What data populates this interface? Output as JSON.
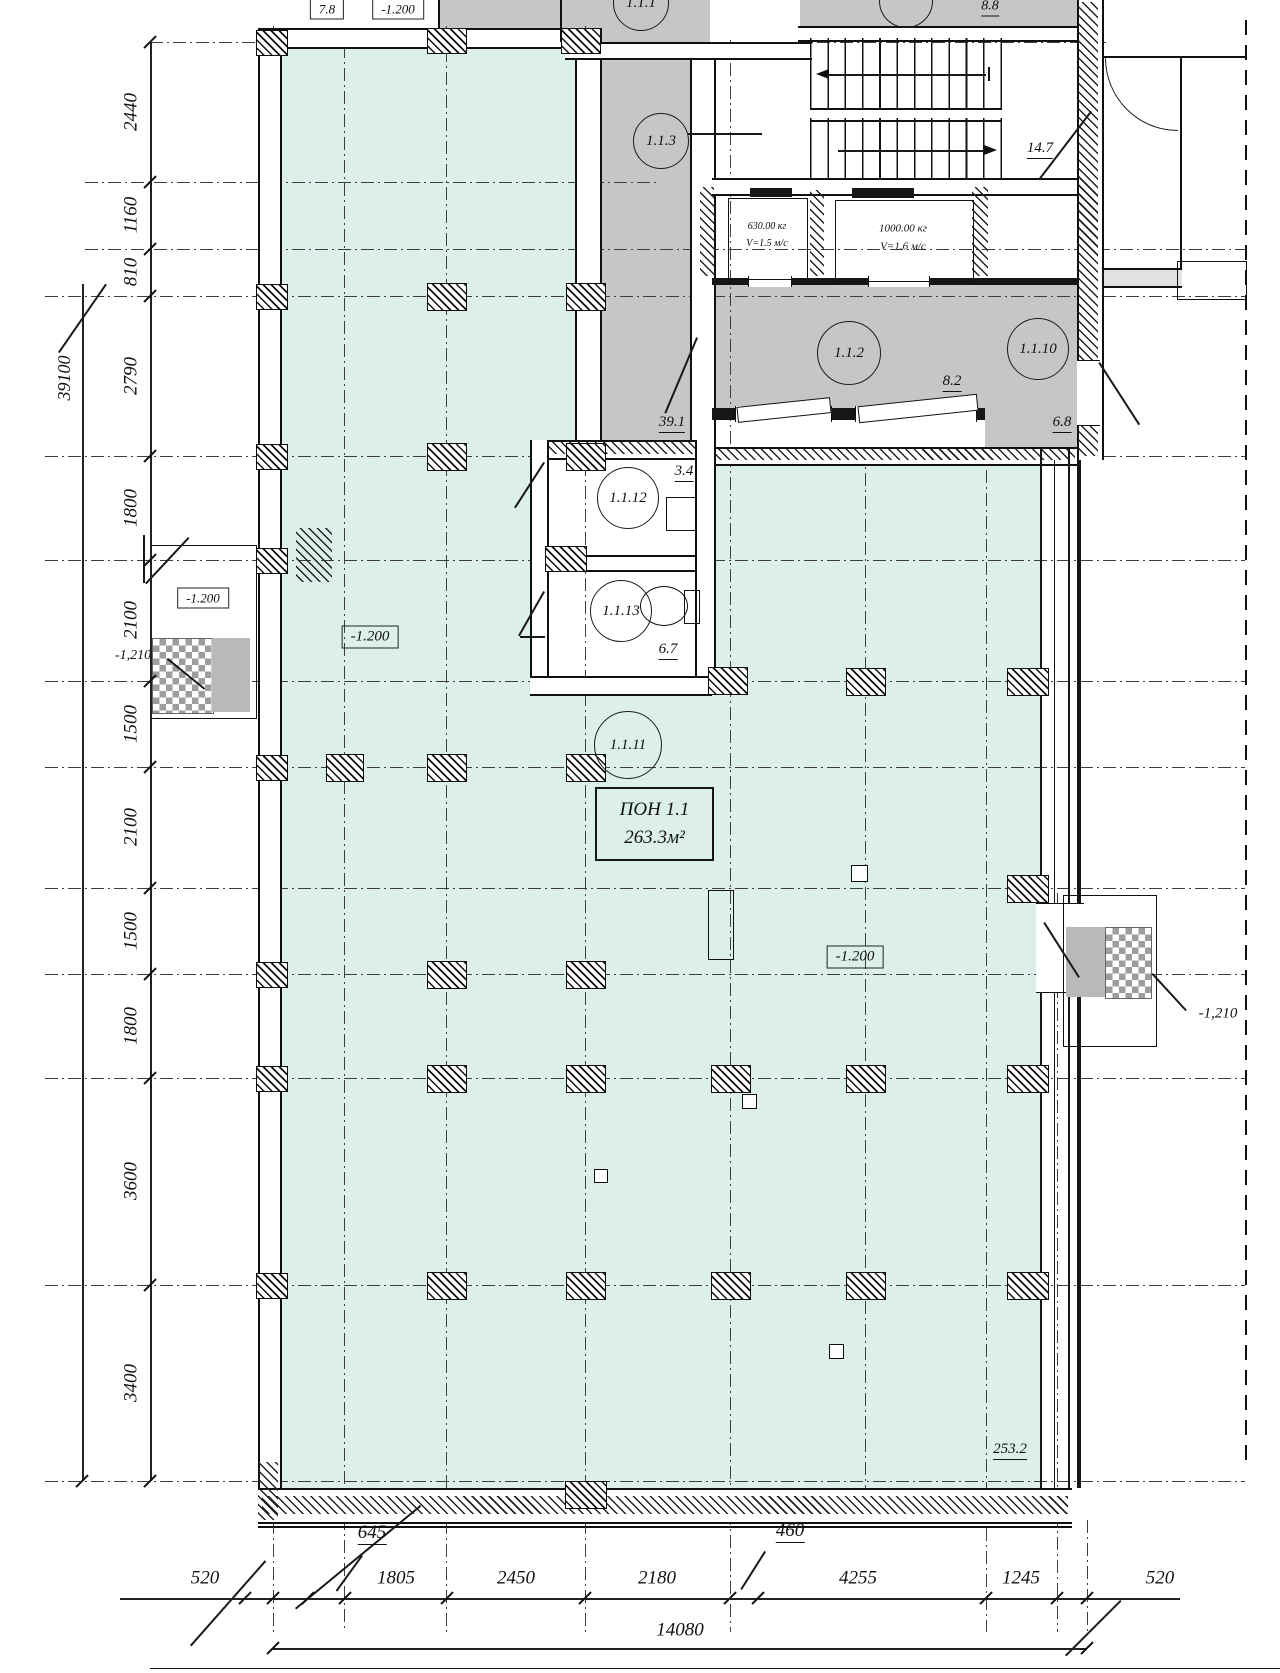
{
  "canvas": {
    "w": 1280,
    "h": 1673
  },
  "colors": {
    "hall_fill": "#dcefe8",
    "room_fill": "#c6c6c6",
    "line": "#161616"
  },
  "zone": {
    "box": [
      595,
      787,
      115,
      70
    ],
    "line1": "ПОН 1.1",
    "line2": "263.3м²"
  },
  "room_tags": [
    {
      "label": "1.1.1",
      "cx": 640,
      "cy": 2,
      "r": 27
    },
    {
      "label": "",
      "cx": 905,
      "cy": 0,
      "r": 26
    },
    {
      "label": "1.1.3",
      "cx": 660,
      "cy": 140,
      "r": 27
    },
    {
      "label": "1.1.2",
      "cx": 848,
      "cy": 352,
      "r": 31
    },
    {
      "label": "1.1.10",
      "cx": 1037,
      "cy": 348,
      "r": 30
    },
    {
      "label": "1.1.12",
      "cx": 627,
      "cy": 497,
      "r": 30
    },
    {
      "label": "1.1.13",
      "cx": 620,
      "cy": 610,
      "r": 30
    },
    {
      "label": "1.1.11",
      "cx": 627,
      "cy": 744,
      "r": 33
    }
  ],
  "labels": [
    {
      "t": "7.8",
      "x": 327,
      "y": 9,
      "s": 13,
      "st": "bx"
    },
    {
      "t": "-1.200",
      "x": 398,
      "y": 9,
      "s": 13,
      "st": "bx"
    },
    {
      "t": "8.8",
      "x": 990,
      "y": 8,
      "s": 14,
      "st": "u"
    },
    {
      "t": "14.7",
      "x": 1040,
      "y": 150,
      "s": 15,
      "st": "u"
    },
    {
      "t": "630.00 кг",
      "x": 767,
      "y": 227,
      "s": 10
    },
    {
      "t": "V=1.5 м/с",
      "x": 767,
      "y": 244,
      "s": 10
    },
    {
      "t": "1000.00 кг",
      "x": 903,
      "y": 229,
      "s": 11
    },
    {
      "t": "V=1.6 м/с",
      "x": 903,
      "y": 247,
      "s": 11
    },
    {
      "t": "8.2",
      "x": 952,
      "y": 383,
      "s": 15,
      "st": "u"
    },
    {
      "t": "6.8",
      "x": 1062,
      "y": 424,
      "s": 15,
      "st": "u"
    },
    {
      "t": "39.1",
      "x": 672,
      "y": 424,
      "s": 15,
      "st": "u"
    },
    {
      "t": "3.4",
      "x": 684,
      "y": 473,
      "s": 15,
      "st": "u"
    },
    {
      "t": "6.7",
      "x": 668,
      "y": 651,
      "s": 15,
      "st": "u"
    },
    {
      "t": "253.2",
      "x": 1010,
      "y": 1451,
      "s": 15,
      "st": "u"
    },
    {
      "t": "-1.200",
      "x": 370,
      "y": 637,
      "s": 15,
      "st": "bx"
    },
    {
      "t": "-1.200",
      "x": 855,
      "y": 957,
      "s": 15,
      "st": "bx"
    },
    {
      "t": "-1.200",
      "x": 203,
      "y": 598,
      "s": 13,
      "st": "bx"
    },
    {
      "t": "-1,210",
      "x": 133,
      "y": 656,
      "s": 14
    },
    {
      "t": "-1,210",
      "x": 1218,
      "y": 1014,
      "s": 15
    },
    {
      "t": "39100",
      "x": 64,
      "y": 378,
      "s": 18,
      "r": -90
    }
  ],
  "dims_left": {
    "line": {
      "x": 150,
      "y1": 42,
      "y2": 1481
    },
    "outer_line": {
      "x": 82,
      "y1": 284,
      "y2": 1481
    },
    "ticks": [
      42,
      182,
      249,
      296,
      456,
      560,
      681,
      767,
      888,
      974,
      1078,
      1285,
      1481
    ],
    "labels": [
      {
        "t": "2440",
        "y": 112
      },
      {
        "t": "1160",
        "y": 215
      },
      {
        "t": "810",
        "y": 272
      },
      {
        "t": "2790",
        "y": 376
      },
      {
        "t": "1800",
        "y": 508
      },
      {
        "t": "2100",
        "y": 620
      },
      {
        "t": "1500",
        "y": 724
      },
      {
        "t": "2100",
        "y": 827
      },
      {
        "t": "1500",
        "y": 931
      },
      {
        "t": "1800",
        "y": 1026
      },
      {
        "t": "3600",
        "y": 1181
      },
      {
        "t": "3400",
        "y": 1383
      }
    ],
    "label_x": 131,
    "total": "39100"
  },
  "dims_bottom": {
    "line": {
      "y": 1598,
      "x1": 120,
      "x2": 1180
    },
    "ticks": [
      245,
      273,
      308,
      345,
      447,
      585,
      730,
      758,
      986,
      1057,
      1087
    ],
    "labels": [
      {
        "t": "520",
        "x": 205,
        "y": 1578
      },
      {
        "t": "645",
        "x": 372,
        "y": 1534,
        "st": "u"
      },
      {
        "t": "1805",
        "x": 396,
        "y": 1578
      },
      {
        "t": "2450",
        "x": 516,
        "y": 1578
      },
      {
        "t": "2180",
        "x": 657,
        "y": 1578
      },
      {
        "t": "460",
        "x": 790,
        "y": 1532,
        "st": "u"
      },
      {
        "t": "4255",
        "x": 858,
        "y": 1578
      },
      {
        "t": "1245",
        "x": 1021,
        "y": 1578
      },
      {
        "t": "520",
        "x": 1160,
        "y": 1578
      }
    ],
    "total": {
      "t": "14080",
      "x": 680,
      "y": 1630,
      "line_y": 1648,
      "x1": 273,
      "x2": 1087
    },
    "base_line": {
      "y": 1668,
      "x1": 150,
      "x2": 1280
    }
  },
  "grid": {
    "h": [
      {
        "y": 42,
        "x1": 150,
        "x2": 1110
      },
      {
        "y": 182,
        "x1": 85,
        "x2": 660
      },
      {
        "y": 249,
        "x1": 85,
        "x2": 1245
      },
      {
        "y": 296,
        "x1": 45,
        "x2": 1245
      },
      {
        "y": 456
      },
      {
        "y": 560
      },
      {
        "y": 681
      },
      {
        "y": 767
      },
      {
        "y": 888
      },
      {
        "y": 974
      },
      {
        "y": 1078
      },
      {
        "y": 1285
      },
      {
        "y": 1481
      }
    ],
    "v": [
      {
        "x": 273,
        "y1": 26,
        "y2": 1632
      },
      {
        "x": 344,
        "y1": 45,
        "y2": 1632
      },
      {
        "x": 446,
        "y1": 26,
        "y2": 1632
      },
      {
        "x": 585,
        "y1": 26,
        "y2": 1632
      },
      {
        "x": 730,
        "y1": 40,
        "y2": 1632
      },
      {
        "x": 865,
        "y1": 450,
        "y2": 1525
      },
      {
        "x": 986,
        "y1": 447,
        "y2": 1632
      },
      {
        "x": 1057,
        "y1": 893,
        "y2": 1632
      },
      {
        "x": 1087,
        "y1": 1520,
        "y2": 1632
      }
    ],
    "bold_dashed_v": [
      {
        "x": 1245,
        "y1": 20,
        "y2": 1470
      }
    ]
  },
  "fills": [
    [
      258,
      0,
      340,
      28,
      "white"
    ],
    [
      438,
      0,
      160,
      28,
      "gray"
    ],
    [
      560,
      0,
      150,
      44,
      "gray"
    ],
    [
      800,
      0,
      302,
      26,
      "gray"
    ],
    [
      278,
      45,
      302,
      411,
      "mint"
    ],
    [
      278,
      456,
      762,
      1032,
      "mint"
    ],
    [
      598,
      56,
      92,
      400,
      "gray"
    ],
    [
      712,
      56,
      86,
      122,
      "white"
    ],
    [
      1000,
      38,
      78,
      140,
      "white"
    ],
    [
      712,
      285,
      273,
      123,
      "gray"
    ],
    [
      985,
      285,
      92,
      167,
      "gray"
    ],
    [
      530,
      440,
      182,
      252,
      "white"
    ],
    [
      1100,
      268,
      82,
      20,
      "lgray"
    ],
    [
      150,
      545,
      105,
      172,
      "white"
    ],
    [
      1063,
      895,
      92,
      150,
      "white"
    ]
  ],
  "geom": [
    {
      "k": "wbv",
      "b": [
        258,
        28,
        20,
        1492
      ]
    },
    {
      "k": "wb",
      "b": [
        258,
        28,
        340,
        17
      ]
    },
    {
      "k": "wbv",
      "b": [
        575,
        28,
        23,
        430
      ]
    },
    {
      "k": "wbv",
      "b": [
        690,
        45,
        22,
        413
      ]
    },
    {
      "k": "wb",
      "b": [
        565,
        42,
        247,
        14
      ]
    },
    {
      "k": "wb",
      "b": [
        798,
        26,
        304,
        12
      ]
    },
    {
      "k": "wb",
      "b": [
        712,
        178,
        368,
        14
      ]
    },
    {
      "k": "hx",
      "b": [
        700,
        187,
        14,
        89
      ]
    },
    {
      "k": "hx",
      "b": [
        810,
        190,
        14,
        86
      ]
    },
    {
      "k": "hx",
      "b": [
        972,
        187,
        16,
        89
      ]
    },
    {
      "k": "dk",
      "b": [
        750,
        188,
        42,
        9
      ]
    },
    {
      "k": "dk",
      "b": [
        852,
        188,
        62,
        10
      ]
    },
    {
      "k": "dk",
      "b": [
        712,
        278,
        273,
        7
      ]
    },
    {
      "k": "dk",
      "b": [
        985,
        278,
        115,
        7
      ]
    },
    {
      "k": "gap",
      "b": [
        748,
        276,
        42,
        11
      ]
    },
    {
      "k": "gap",
      "b": [
        868,
        276,
        60,
        11
      ]
    },
    {
      "k": "dk",
      "b": [
        712,
        408,
        273,
        12
      ]
    },
    {
      "k": "gap",
      "b": [
        735,
        406,
        95,
        16
      ]
    },
    {
      "k": "gap",
      "b": [
        855,
        406,
        120,
        16
      ]
    },
    {
      "k": "leaf",
      "b": [
        737,
        402,
        92,
        14
      ]
    },
    {
      "k": "leaf",
      "b": [
        858,
        400,
        118,
        15
      ]
    },
    {
      "k": "wb",
      "b": [
        712,
        447,
        365,
        15
      ]
    },
    {
      "k": "hx",
      "b": [
        714,
        449,
        361,
        11
      ]
    },
    {
      "k": "wb",
      "b": [
        530,
        440,
        182,
        16
      ]
    },
    {
      "k": "hx",
      "b": [
        532,
        442,
        178,
        12
      ]
    },
    {
      "k": "wbv",
      "b": [
        530,
        440,
        15,
        252
      ]
    },
    {
      "k": "wbv",
      "b": [
        695,
        440,
        17,
        252
      ]
    },
    {
      "k": "wb",
      "b": [
        545,
        555,
        150,
        13
      ]
    },
    {
      "k": "wb",
      "b": [
        530,
        676,
        182,
        16
      ]
    },
    {
      "k": "wbv",
      "b": [
        1077,
        0,
        23,
        460
      ]
    },
    {
      "k": "hx",
      "b": [
        1079,
        2,
        19,
        454
      ]
    },
    {
      "k": "gapv",
      "b": [
        1077,
        360,
        23,
        64
      ]
    },
    {
      "k": "hthin",
      "b": [
        1102,
        56,
        143,
        2
      ]
    },
    {
      "k": "vthin",
      "b": [
        1180,
        56,
        2,
        212
      ]
    },
    {
      "k": "hthin",
      "b": [
        1102,
        268,
        80,
        2
      ]
    },
    {
      "k": "hthin",
      "b": [
        1102,
        286,
        80,
        2
      ]
    },
    {
      "k": "ol",
      "b": [
        1177,
        261,
        68,
        37
      ]
    },
    {
      "k": "dk",
      "b": [
        1040,
        447,
        2,
        1073
      ]
    },
    {
      "k": "vthin",
      "b": [
        1054,
        460,
        1,
        1028
      ]
    },
    {
      "k": "dk",
      "b": [
        1068,
        447,
        2,
        1073
      ]
    },
    {
      "k": "dk",
      "b": [
        1077,
        460,
        4,
        1028
      ]
    },
    {
      "k": "gapv",
      "b": [
        1036,
        903,
        48,
        88
      ]
    },
    {
      "k": "wb",
      "b": [
        258,
        1488,
        814,
        32
      ]
    },
    {
      "k": "hx",
      "b": [
        262,
        1496,
        806,
        18
      ]
    },
    {
      "k": "hthin",
      "b": [
        258,
        1526,
        814,
        1.5
      ]
    },
    {
      "k": "hx",
      "b": [
        258,
        1462,
        20,
        58
      ]
    },
    {
      "k": "hx",
      "b": [
        296,
        528,
        36,
        54
      ]
    },
    {
      "k": "ol",
      "b": [
        150,
        545,
        105,
        172
      ]
    },
    {
      "k": "mat",
      "b": [
        152,
        638,
        60,
        74
      ]
    },
    {
      "k": "ramp",
      "b": [
        212,
        638,
        38,
        74
      ]
    },
    {
      "k": "ol",
      "b": [
        1063,
        895,
        92,
        150
      ]
    },
    {
      "k": "mat",
      "b": [
        1105,
        927,
        45,
        70
      ]
    },
    {
      "k": "ramp",
      "b": [
        1066,
        927,
        39,
        70
      ]
    },
    {
      "k": "ol",
      "b": [
        708,
        890,
        24,
        68
      ]
    },
    {
      "k": "ov",
      "b": [
        640,
        586,
        46,
        38
      ]
    },
    {
      "k": "ol",
      "b": [
        684,
        590,
        14,
        32
      ]
    },
    {
      "k": "ol",
      "b": [
        666,
        497,
        28,
        32
      ]
    },
    {
      "k": "ol",
      "b": [
        728,
        198,
        78,
        80
      ]
    },
    {
      "k": "ol",
      "b": [
        835,
        200,
        137,
        80
      ]
    },
    {
      "k": "tr",
      "b": [
        810,
        38,
        192,
        72
      ]
    },
    {
      "k": "wb",
      "b": [
        810,
        108,
        192,
        10
      ]
    },
    {
      "k": "tr",
      "b": [
        810,
        118,
        192,
        60
      ]
    },
    {
      "k": "dk",
      "b": [
        988,
        67,
        2,
        14
      ]
    },
    {
      "k": "vthin",
      "b": [
        438,
        0,
        2,
        28
      ]
    },
    {
      "k": "vthin",
      "b": [
        560,
        0,
        2,
        42
      ]
    }
  ],
  "diag": [
    [
      688,
      133,
      762,
      133
    ],
    [
      698,
      338,
      666,
      414
    ],
    [
      545,
      463,
      516,
      508
    ],
    [
      545,
      592,
      520,
      636
    ],
    [
      520,
      636,
      545,
      636
    ],
    [
      1100,
      362,
      1140,
      424
    ],
    [
      1045,
      922,
      1080,
      977
    ],
    [
      1153,
      973,
      1187,
      1010
    ],
    [
      168,
      658,
      205,
      688
    ],
    [
      1092,
      112,
      1040,
      180
    ],
    [
      58,
      352,
      105,
      284
    ],
    [
      363,
      1556,
      337,
      1592
    ],
    [
      766,
      1552,
      742,
      1590
    ],
    [
      295,
      1608,
      420,
      1505
    ],
    [
      190,
      1645,
      265,
      1560
    ],
    [
      1065,
      1655,
      1120,
      1600
    ],
    [
      145,
      535,
      145,
      583
    ],
    [
      145,
      583,
      188,
      537
    ],
    [
      828,
      74,
      986,
      74
    ],
    [
      838,
      150,
      984,
      150
    ]
  ],
  "arrows": [
    {
      "x": 816,
      "y": 69,
      "dir": "l"
    },
    {
      "x": 984,
      "y": 145,
      "dir": "r"
    }
  ],
  "arcs": [
    {
      "x": 1105,
      "y": 58,
      "r": 72
    }
  ],
  "columns": [
    [
      271,
      42,
      30,
      24
    ],
    [
      446,
      40,
      38,
      24
    ],
    [
      580,
      40,
      38,
      24
    ],
    [
      271,
      296,
      30,
      24
    ],
    [
      446,
      296,
      38,
      26
    ],
    [
      585,
      296,
      38,
      26
    ],
    [
      271,
      456,
      30,
      24
    ],
    [
      446,
      456,
      38,
      26
    ],
    [
      585,
      456,
      38,
      26
    ],
    [
      565,
      558,
      40,
      24
    ],
    [
      271,
      560,
      30,
      24
    ],
    [
      727,
      680,
      38,
      26
    ],
    [
      865,
      681,
      38,
      26
    ],
    [
      1027,
      681,
      40,
      26
    ],
    [
      271,
      767,
      30,
      24
    ],
    [
      344,
      767,
      36,
      26
    ],
    [
      446,
      767,
      38,
      26
    ],
    [
      585,
      767,
      38,
      26
    ],
    [
      1027,
      888,
      40,
      26
    ],
    [
      271,
      974,
      30,
      24
    ],
    [
      446,
      974,
      38,
      26
    ],
    [
      585,
      974,
      38,
      26
    ],
    [
      271,
      1078,
      30,
      24
    ],
    [
      446,
      1078,
      38,
      26
    ],
    [
      585,
      1078,
      38,
      26
    ],
    [
      730,
      1078,
      38,
      26
    ],
    [
      865,
      1078,
      38,
      26
    ],
    [
      1027,
      1078,
      40,
      26
    ],
    [
      271,
      1285,
      30,
      24
    ],
    [
      446,
      1285,
      38,
      26
    ],
    [
      585,
      1285,
      38,
      26
    ],
    [
      730,
      1285,
      38,
      26
    ],
    [
      865,
      1285,
      38,
      26
    ],
    [
      1027,
      1285,
      40,
      26
    ],
    [
      585,
      1494,
      40,
      26
    ]
  ],
  "small_squares": [
    [
      858,
      872,
      15
    ],
    [
      748,
      1100,
      13
    ],
    [
      600,
      1175,
      12
    ],
    [
      835,
      1350,
      13
    ]
  ]
}
